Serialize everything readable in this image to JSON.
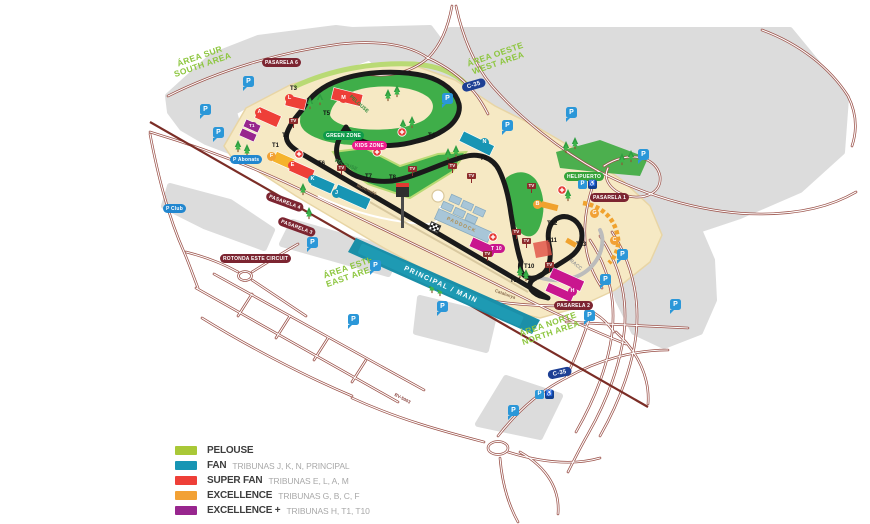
{
  "palette": {
    "pelouse": "#a9c837",
    "fan": "#1795b4",
    "super_fan": "#ee3f38",
    "excellence": "#f2a135",
    "excellence_plus": "#98268e",
    "magenta": "#c9168e",
    "road": "#9b524a",
    "track": "#1a1a1a",
    "terrain": "#f6e9c4",
    "green_zone_fill": "#3fae49",
    "gray_zone": "#dcdcdc"
  },
  "legend": {
    "items": [
      {
        "label": "PELOUSE",
        "sublabel": "",
        "color": "#a9c837"
      },
      {
        "label": "FAN",
        "sublabel": "TRIBUNAS  J, K, N, PRINCIPAL",
        "color": "#1795b4"
      },
      {
        "label": "SUPER FAN",
        "sublabel": "TRIBUNAS E, L, A, M",
        "color": "#ee3f38"
      },
      {
        "label": "EXCELLENCE",
        "sublabel": "TRIBUNAS  G, B, C, F",
        "color": "#f2a135"
      },
      {
        "label": "EXCELLENCE +",
        "sublabel": "TRIBUNAS  H, T1, T10",
        "color": "#98268e"
      }
    ]
  },
  "areas": {
    "south": {
      "line1": "ÁREA SUR",
      "line2": "SOUTH AREA"
    },
    "west": {
      "line1": "ÁREA OESTE",
      "line2": "WEST AREA"
    },
    "east": {
      "line1": "ÁREA ESTE",
      "line2": "EAST AREA"
    },
    "north": {
      "line1": "ÁREA NORTE",
      "line2": "NORTH AREA"
    }
  },
  "turns": {
    "t1": "T1",
    "t2": "T2",
    "t3": "T3",
    "t4": "T4",
    "t5": "T5",
    "t6": "T6",
    "t7": "T7",
    "t8": "T8",
    "t9": "T9",
    "t10": "T10",
    "t11": "T11",
    "t12": "T12",
    "t13": "T13",
    "t14": "T14"
  },
  "tribunes": {
    "f": "F",
    "e": "E",
    "k": "K",
    "j": "J",
    "a": "A",
    "l": "L",
    "m": "M",
    "n": "N",
    "h": "H",
    "t1": "T1",
    "t10": "T 10",
    "b": "B",
    "g": "G",
    "c": "C"
  },
  "badges": {
    "pasarela1": "PASARELA 1",
    "pasarela2": "PASARELA 2",
    "pasarela3": "PASARELA 3",
    "pasarela4": "PASARELA 4",
    "pasarela6": "PASARELA 6",
    "rotonda": "ROTONDA ESTE CIRCUIT",
    "helipuerto": "HELIPUERTO",
    "green_zone": "GREEN ZONE",
    "kids_zone": "KIDS ZONE",
    "p_abonats": "P Abonats",
    "p_club": "P Club"
  },
  "roads": {
    "c35": "C-35",
    "bv5003": "BV-5003"
  },
  "map_texts": {
    "principal": "PRINCIPAL / MAIN",
    "paddock": "PADDOCK",
    "pelouse": "PELOUSE",
    "montmelo": "Montmeló",
    "catalunya": "Catalunya",
    "racc": "RACC"
  },
  "icons": {
    "parking_label": "P",
    "tv_label": "TV",
    "accessible_label": "♿"
  }
}
